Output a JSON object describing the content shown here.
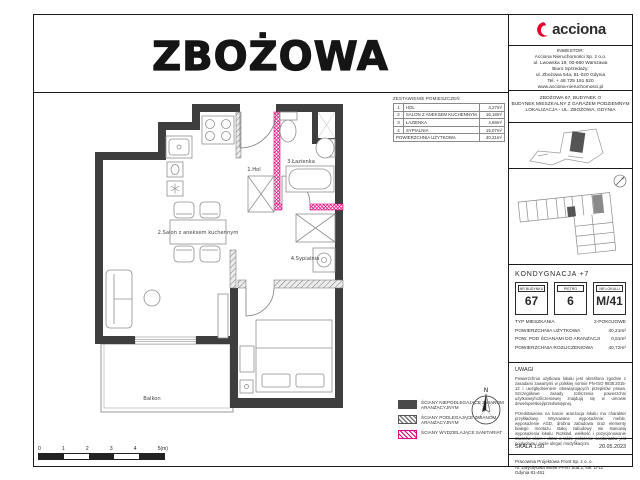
{
  "logo_text": "ZBOŻOWA",
  "brand": {
    "name": "acciona"
  },
  "investor": {
    "label": "INWESTOR:",
    "lines": [
      "Acciona Nieruchomości Sp. z o.o.",
      "ul. Lwowska 19, 00-660 Warszawa",
      "Biuro Sprzedaży:",
      "ul. Zbożowa 54a, 81-020 Gdynia",
      "Tel. + 48 725 151 520",
      "www.acciona-nieruchomosci.pl"
    ]
  },
  "project": {
    "lines": [
      "ZBOŻOWA 67, BUDYNEK O",
      "BUDYNEK MIESZKALNY Z GARAŻEM PODZIEMNYM",
      "LOKALIZACJA - UL. ZBOŻOWA, GDYNIA"
    ]
  },
  "kondygnacja": {
    "title": "KONDYGNACJA +7",
    "boxes": [
      {
        "label": "NR BUDYNKU",
        "value": "67"
      },
      {
        "label": "PIĘTRO",
        "value": "6"
      },
      {
        "label": "NR LOKALU",
        "value": "M/41"
      }
    ],
    "rows": [
      {
        "label": "TYP MIESZKANIA",
        "value": "2-POKOJOWE"
      },
      {
        "label": "POWIERZCHNIA UŻYTKOWA",
        "value": "40,21m²"
      },
      {
        "label": "POW. POD ŚCIANAMI DO ARANŻACJI",
        "value": "0,51m²"
      },
      {
        "label": "POWIERZCHNIA ROZLICZENIOWA",
        "value": "40,72m²"
      }
    ]
  },
  "uwagi": {
    "title": "UWAGI",
    "p1": "Powierzchnia użytkowa lokalu jest określona zgodnie z zasadami zawartymi w polskiej normie PN-ISO 9836:2015-12 i uwzględnieniem obowiązujących przepisów prawa. Szczegółowe zasady rozliczenia powierzchni użytkowej/rozliczeniowej znajdują się w umowie deweloperskiej/przedwstępnej.",
    "p2": "Przedstawiona na karcie aranżacja lokalu ma charakter przykładowy. Wrysowane wyposażenie: meble, wyposażenie AGD, drobna zabudowa oraz elementy białego montażu stałej zabudowy nie stanowią wyposażenia lokalu. Rozkład, wielkość i pozycjonowanie otworów okien i drzwi a także położenie sanitariatów jest poglądowe i może ulegać modyfikacjom."
  },
  "skala": {
    "label": "SKALA 1:50",
    "date": "20.05.2023"
  },
  "footer": {
    "lines": [
      "Pracownia Projektowa Front Sp. z o. o.",
      "Al. Zwycięstwa 96/98 PPNT bud.2, lok. D-11",
      "Gdynia 81-451"
    ]
  },
  "rooms_table": {
    "title": "ZESTAWIENIE POMIESZCZEŃ",
    "rows": [
      {
        "no": "1",
        "name": "HOL",
        "area": "4,27m²"
      },
      {
        "no": "2",
        "name": "SALON Z ANEKSEM KUCHENNYM",
        "area": "16,18m²"
      },
      {
        "no": "3",
        "name": "ŁAZIENKA",
        "area": "4,69m²"
      },
      {
        "no": "4",
        "name": "SYPIALNIA",
        "area": "15,07m²"
      }
    ],
    "total_label": "POWIERZCHNIA UŻYTKOWA",
    "total_value": "40,21m²"
  },
  "plan": {
    "labels": {
      "hol": "1.Hol",
      "lazienka": "3.Łazienka",
      "salon": "2.Salon z aneksem kuchennym",
      "sypialnia": "4.Sypialnia",
      "balkon": "Balkon"
    }
  },
  "legend": {
    "items": [
      {
        "label": "ŚCIANY NIEPODLEGAJĄCE ZMIANOM ARANŻACYJNYM"
      },
      {
        "label": "ŚCIANY PODLEGAJĄCE ZMIANOM ARANŻACYJNYM"
      },
      {
        "label": "ŚCIANY WYDZIELAJĄCE SANITARIAT"
      }
    ]
  },
  "scale_bar": {
    "ticks": [
      "0",
      "1",
      "2",
      "3",
      "4",
      "5(m)"
    ]
  },
  "compass": {
    "label": "N"
  },
  "colors": {
    "wall_dark": "#3e3e3e",
    "sanitary_pink": "#e6007e",
    "accent_red": "#e4002b",
    "highlight_gray": "#8a8a8a"
  }
}
